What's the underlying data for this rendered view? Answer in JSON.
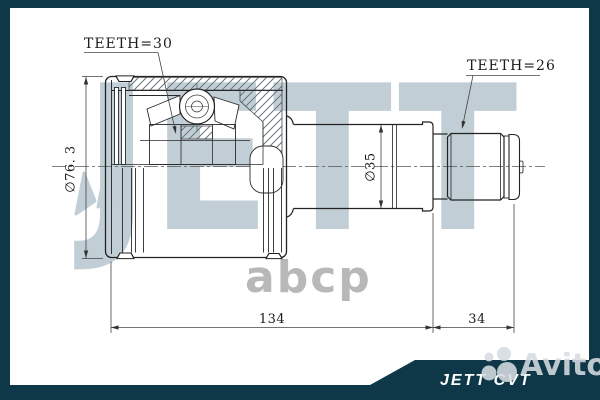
{
  "drawing": {
    "callouts": {
      "teeth_left": "TEETH=30",
      "teeth_right": "TEETH=26"
    },
    "dimensions": {
      "outer_diameter": "∅76. 3",
      "shaft_diameter": "∅35",
      "body_length": "134",
      "spline_length": "34"
    }
  },
  "watermarks": {
    "brand": "JETT",
    "supplier": "abcp",
    "marketplace": "Avito"
  },
  "footer": {
    "product_label": "JETT CVT"
  },
  "colors": {
    "frame": "#0e3748",
    "line_dark": "#222222",
    "brand_watermark": "#c1ced5",
    "supplier_watermark": "#b8b8b8",
    "footer_text": "#ffffff"
  }
}
